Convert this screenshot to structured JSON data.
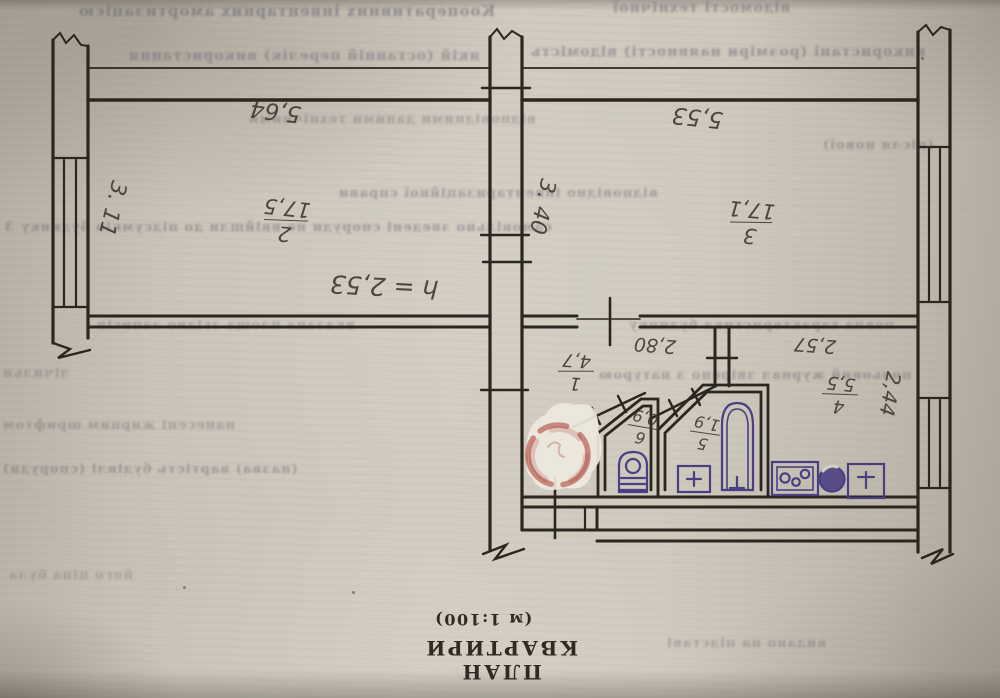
{
  "title_block": {
    "title": "ПЛАН КВАРТИРИ",
    "scale": "(м 1:100)"
  },
  "labels": {
    "room2_num": "2",
    "room2_area": "17,5",
    "room2_width": "5,64",
    "room2_depth": "3. 11",
    "room3_num": "3",
    "room3_area": "17,1",
    "room3_width": "5,53",
    "room3_depth": "3. 40",
    "hall_num": "1",
    "hall_area": "4,7",
    "hall_width": "2,80",
    "kitchen_num": "4",
    "kitchen_area": "5,5",
    "kitchen_width": "2,57",
    "kitchen_depth": "2,44",
    "bath_num": "5",
    "bath_area": "1,9",
    "wc_num": "6",
    "wc_area": "0,9",
    "ceiling_height": "h = 2,53"
  },
  "colors": {
    "ink": "#2b2620",
    "pencil": "#3b362d",
    "fixture_ink": "#4a3f85",
    "stamp_red": "#a93a2e",
    "paper": "#cbc5b9"
  },
  "bleedthrough": [
    "Кооперативних інвентарних амортизацією",
    "відомості технічної",
    "якій (останній перелік) використання",
    "використані (розміри наявності) відомість",
    "відповідними даними технічними",
    "(після нової)",
    "відповідно інвентаризаційної справи",
    "самовільно зведені споруди не ввійшли до підсумків будинку З",
    "вказана площа згідно записів",
    "повна характеристика будинку",
    "польовий журнал звірено з натурою",
    "лічильн",
    "нанесені жирним шрифтом",
    "(назва) вартість будівлі (споруди)",
    "його ціна була",
    "видано на підставі"
  ]
}
